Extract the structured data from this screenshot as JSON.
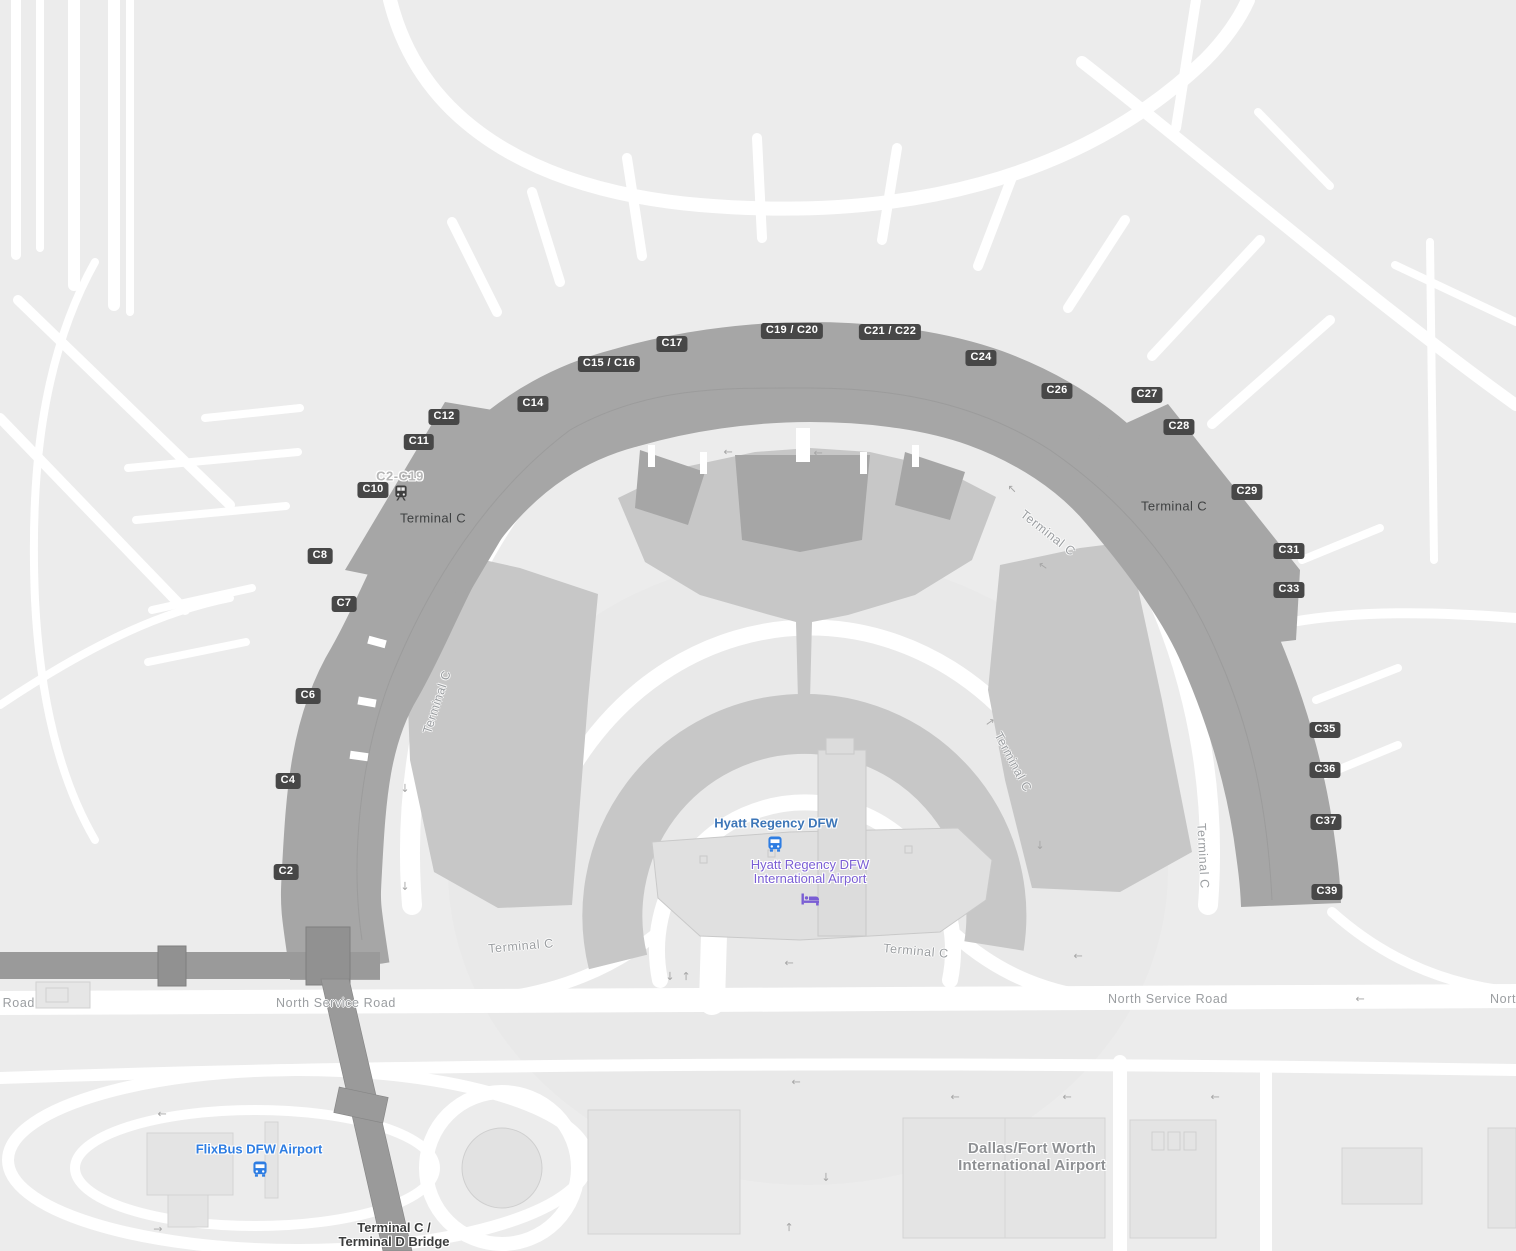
{
  "map": {
    "colors": {
      "background": "#ececec",
      "road": "#ffffff",
      "terminal_building": "#a6a6a6",
      "parking_structure": "#c7c7c7",
      "bridge_gray": "#9a9a9a",
      "gate_badge_bg": "#474747",
      "gate_badge_text": "#ffffff",
      "building_label": "#3f4142",
      "road_label": "#9b9ea1",
      "hyatt_stop_blue": "#3d76b8",
      "hotel_purple": "#7a5ed4",
      "flixbus_blue": "#2e7de2",
      "dfw_label_gray": "#8e9093"
    },
    "icons": [
      "train-icon",
      "bus-icon",
      "bed-icon"
    ],
    "gates": [
      {
        "label": "C2",
        "x": 286,
        "y": 872
      },
      {
        "label": "C4",
        "x": 288,
        "y": 781
      },
      {
        "label": "C6",
        "x": 308,
        "y": 696
      },
      {
        "label": "C7",
        "x": 344,
        "y": 604
      },
      {
        "label": "C8",
        "x": 320,
        "y": 556
      },
      {
        "label": "C10",
        "x": 373,
        "y": 490
      },
      {
        "label": "C11",
        "x": 419,
        "y": 442
      },
      {
        "label": "C12",
        "x": 444,
        "y": 417
      },
      {
        "label": "C14",
        "x": 533,
        "y": 404
      },
      {
        "label": "C15 / C16",
        "x": 609,
        "y": 364
      },
      {
        "label": "C17",
        "x": 672,
        "y": 344
      },
      {
        "label": "C19 / C20",
        "x": 792,
        "y": 331
      },
      {
        "label": "C21 / C22",
        "x": 890,
        "y": 332
      },
      {
        "label": "C24",
        "x": 981,
        "y": 358
      },
      {
        "label": "C26",
        "x": 1057,
        "y": 391
      },
      {
        "label": "C27",
        "x": 1147,
        "y": 395
      },
      {
        "label": "C28",
        "x": 1179,
        "y": 427
      },
      {
        "label": "C29",
        "x": 1247,
        "y": 492
      },
      {
        "label": "C31",
        "x": 1289,
        "y": 551
      },
      {
        "label": "C33",
        "x": 1289,
        "y": 590
      },
      {
        "label": "C35",
        "x": 1325,
        "y": 730
      },
      {
        "label": "C36",
        "x": 1325,
        "y": 770
      },
      {
        "label": "C37",
        "x": 1326,
        "y": 822
      },
      {
        "label": "C39",
        "x": 1327,
        "y": 892
      }
    ],
    "terminal_labels": [
      {
        "text": "Terminal C",
        "x": 433,
        "y": 518
      },
      {
        "text": "Terminal C",
        "x": 1174,
        "y": 506
      }
    ],
    "road_labels": [
      {
        "text": "North Service Road",
        "x": 336,
        "y": 1003,
        "rot": 0
      },
      {
        "text": "North Service Road",
        "x": 1168,
        "y": 999,
        "rot": 0
      },
      {
        "text": "North Service Road",
        "x": -25,
        "y": 1003,
        "rot": 0
      },
      {
        "text": "North Service Road",
        "x": 1550,
        "y": 999,
        "rot": 0
      },
      {
        "text": "Terminal C",
        "x": 521,
        "y": 946,
        "rot": -5
      },
      {
        "text": "Terminal C",
        "x": 916,
        "y": 951,
        "rot": 5
      },
      {
        "text": "Terminal C",
        "x": 1048,
        "y": 533,
        "rot": 38
      },
      {
        "text": "Terminal C",
        "x": 1013,
        "y": 762,
        "rot": 62
      },
      {
        "text": "Terminal C",
        "x": 1203,
        "y": 856,
        "rot": 87
      },
      {
        "text": "Terminal C",
        "x": 437,
        "y": 702,
        "rot": -72
      }
    ],
    "transit_range": {
      "text": "C2-C19",
      "x": 400,
      "y": 476
    },
    "pois": {
      "hyatt_stop": {
        "name": "Hyatt Regency DFW",
        "x": 776,
        "y": 823
      },
      "hyatt_hotel": {
        "line1": "Hyatt Regency DFW",
        "line2": "International Airport",
        "x": 810,
        "y": 872
      },
      "flixbus": {
        "name": "FlixBus DFW Airport",
        "x": 259,
        "y": 1149
      },
      "dfw_airport": {
        "line1": "Dallas/Fort Worth",
        "line2": "International Airport",
        "x": 1032,
        "y": 1157
      },
      "bridge": {
        "line1": "Terminal C /",
        "line2": "Terminal D Bridge",
        "x": 394,
        "y": 1235
      }
    },
    "arrows": [
      {
        "x": 789,
        "y": 963,
        "rot": 180
      },
      {
        "x": 1078,
        "y": 956,
        "rot": 180
      },
      {
        "x": 1360,
        "y": 999,
        "rot": 180
      },
      {
        "x": 1215,
        "y": 1097,
        "rot": 180
      },
      {
        "x": 955,
        "y": 1097,
        "rot": 180
      },
      {
        "x": 1067,
        "y": 1097,
        "rot": 180
      },
      {
        "x": 670,
        "y": 976,
        "rot": 90
      },
      {
        "x": 686,
        "y": 976,
        "rot": -90
      },
      {
        "x": 405,
        "y": 788,
        "rot": 90
      },
      {
        "x": 405,
        "y": 886,
        "rot": 90
      },
      {
        "x": 728,
        "y": 452,
        "rot": 180
      },
      {
        "x": 818,
        "y": 453,
        "rot": 180
      },
      {
        "x": 1012,
        "y": 489,
        "rot": -135
      },
      {
        "x": 1043,
        "y": 566,
        "rot": -145
      },
      {
        "x": 990,
        "y": 722,
        "rot": -35
      },
      {
        "x": 1040,
        "y": 845,
        "rot": 90
      },
      {
        "x": 162,
        "y": 1114,
        "rot": 180
      },
      {
        "x": 158,
        "y": 1229,
        "rot": 0
      },
      {
        "x": 796,
        "y": 1082,
        "rot": 180
      },
      {
        "x": 826,
        "y": 1177,
        "rot": 90
      },
      {
        "x": 789,
        "y": 1227,
        "rot": -90
      }
    ]
  }
}
